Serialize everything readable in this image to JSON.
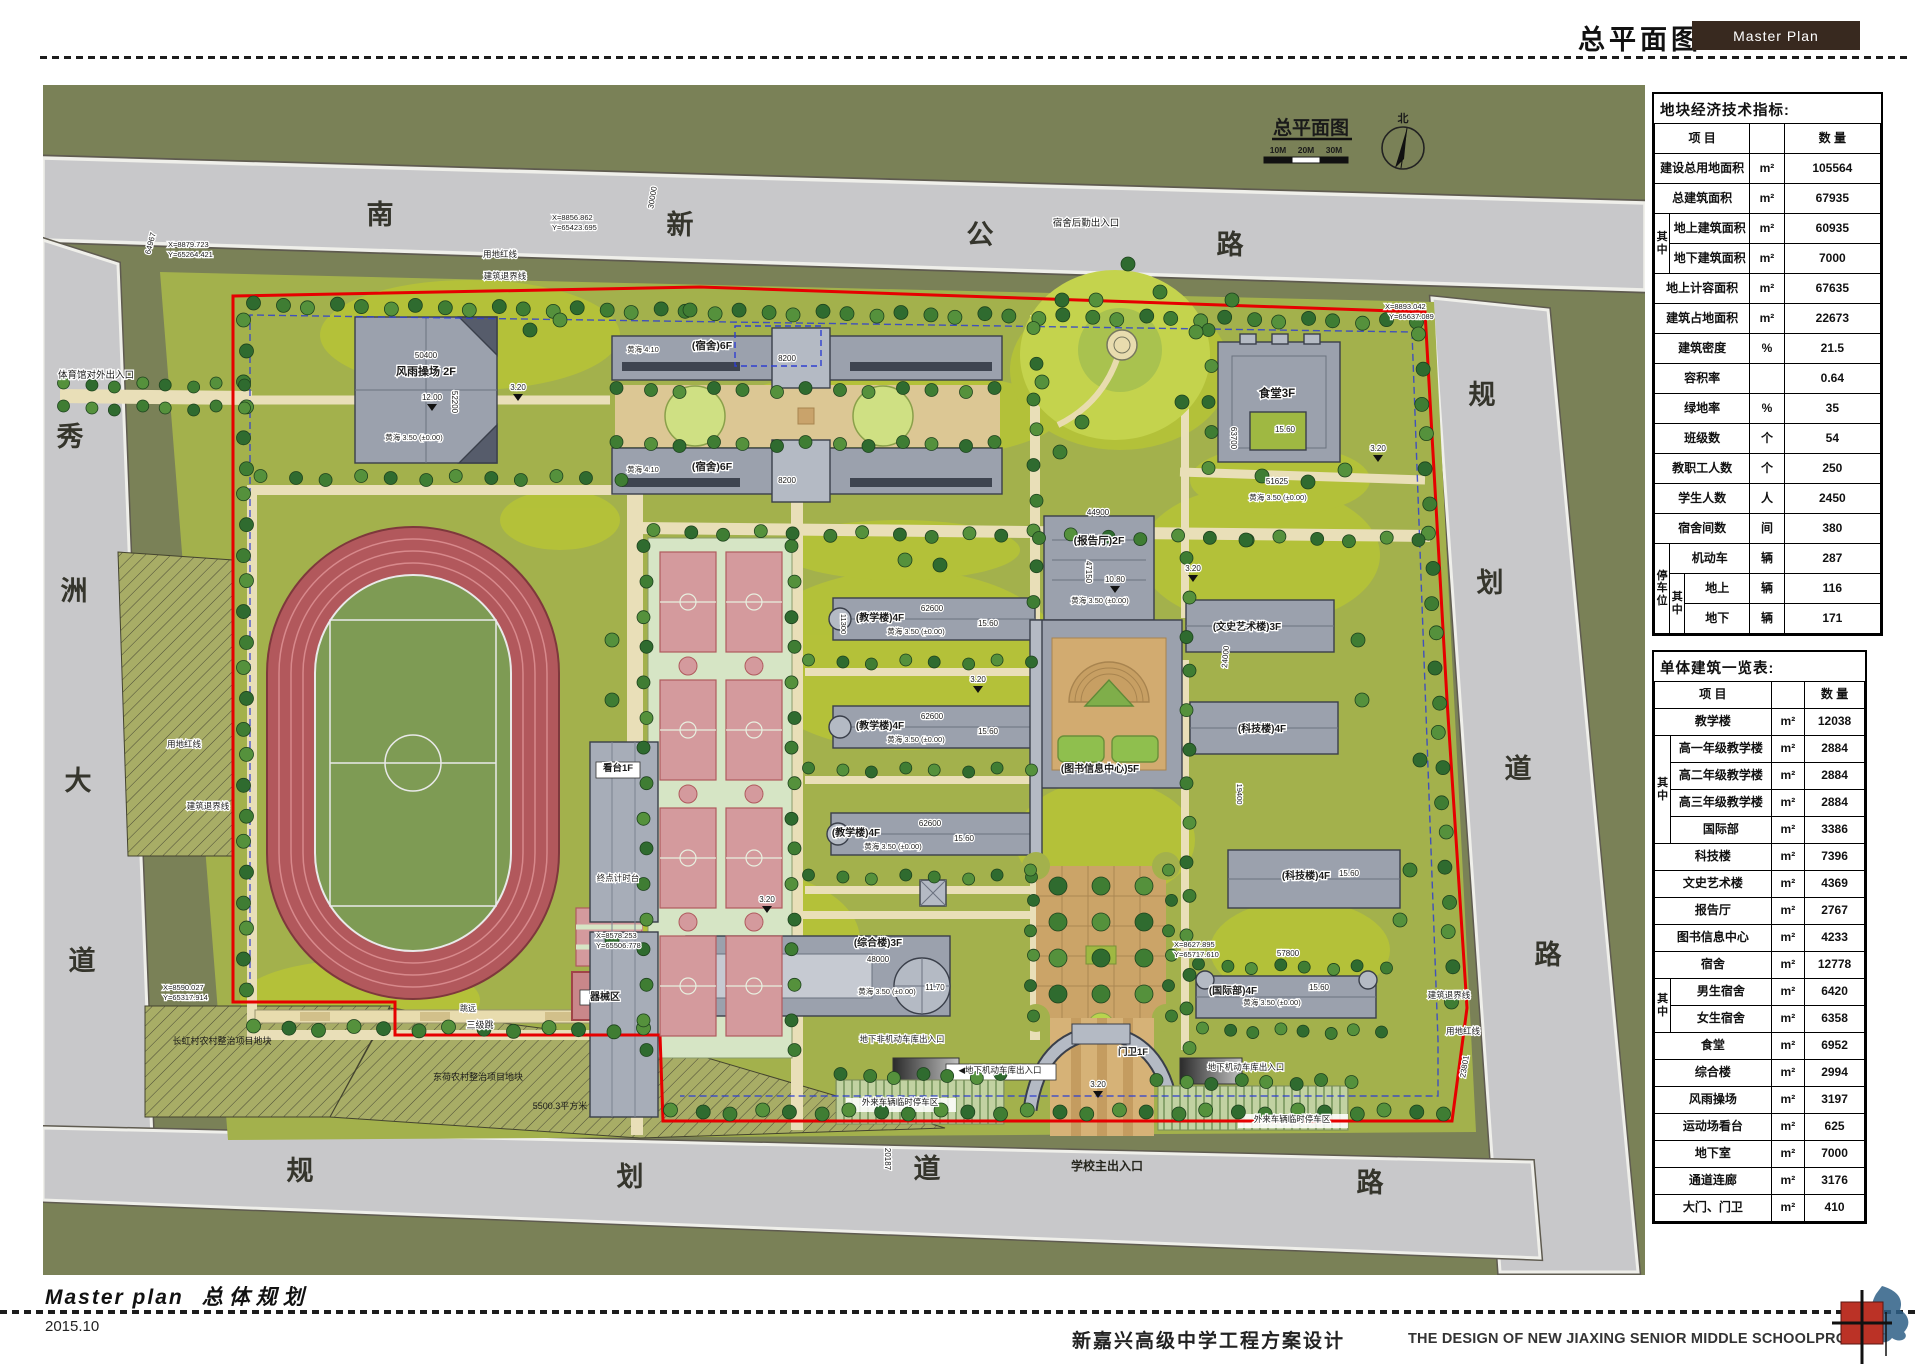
{
  "header": {
    "sheet_title": "总平面图",
    "badge": "Master Plan"
  },
  "footer": {
    "title_en": "Master plan",
    "title_cn": "总体规划",
    "date": "2015.10",
    "project_cn": "新嘉兴高级中学工程方案设计",
    "project_en": "THE DESIGN OF NEW JIAXING SENIOR MIDDLE SCHOOLPROJECT"
  },
  "colors": {
    "badge_bg": "#38291f",
    "boundary_red": "#e60000",
    "setback_blue": "#2f3fd0",
    "road_gray": "#c8c8ca",
    "site_green": "#a3b14c",
    "context_green": "#7a8157"
  },
  "tables": [
    {
      "title": "地块经济技术指标:",
      "item_header": "项    目",
      "qty_header": "数  量",
      "depth": 3,
      "cols": [
        15,
        15,
        64,
        34,
        95
      ],
      "rows": [
        {
          "label": "建设总用地面积",
          "unit": "m²",
          "value": "105564"
        },
        {
          "label": "总建筑面积",
          "unit": "m²",
          "value": "67935"
        },
        {
          "g1": "其中",
          "g1s": 2,
          "label": "地上建筑面积",
          "unit": "m²",
          "value": "60935"
        },
        {
          "label": "地下建筑面积",
          "unit": "m²",
          "value": "7000"
        },
        {
          "label": "地上计容面积",
          "unit": "m²",
          "value": "67635"
        },
        {
          "label": "建筑占地面积",
          "unit": "m²",
          "value": "22673"
        },
        {
          "label": "建筑密度",
          "unit": "%",
          "value": "21.5"
        },
        {
          "label": "容积率",
          "unit": "",
          "value": "0.64"
        },
        {
          "label": "绿地率",
          "unit": "%",
          "value": "35"
        },
        {
          "label": "班级数",
          "unit": "个",
          "value": "54"
        },
        {
          "label": "教职工人数",
          "unit": "个",
          "value": "250"
        },
        {
          "label": "学生人数",
          "unit": "人",
          "value": "2450"
        },
        {
          "label": "宿舍间数",
          "unit": "间",
          "value": "380"
        },
        {
          "g1": "停车位",
          "g1s": 3,
          "label": "机动车",
          "unit": "辆",
          "value": "287"
        },
        {
          "g2": "其中",
          "g2s": 2,
          "label": "地上",
          "unit": "辆",
          "value": "116"
        },
        {
          "label": "地下",
          "unit": "辆",
          "value": "171"
        }
      ]
    },
    {
      "title": "单体建筑一览表:",
      "item_header": "项    目",
      "qty_header": "数  量",
      "depth": 2,
      "cols": [
        16,
        99,
        33,
        59
      ],
      "rows": [
        {
          "label": "教学楼",
          "unit": "m²",
          "value": "12038"
        },
        {
          "g1": "其中",
          "g1s": 4,
          "label": "高一年级教学楼",
          "unit": "m²",
          "value": "2884"
        },
        {
          "label": "高二年级教学楼",
          "unit": "m²",
          "value": "2884"
        },
        {
          "label": "高三年级教学楼",
          "unit": "m²",
          "value": "2884"
        },
        {
          "label": "国际部",
          "unit": "m²",
          "value": "3386"
        },
        {
          "label": "科技楼",
          "unit": "m²",
          "value": "7396"
        },
        {
          "label": "文史艺术楼",
          "unit": "m²",
          "value": "4369"
        },
        {
          "label": "报告厅",
          "unit": "m²",
          "value": "2767"
        },
        {
          "label": "图书信息中心",
          "unit": "m²",
          "value": "4233"
        },
        {
          "label": "宿舍",
          "unit": "m²",
          "value": "12778"
        },
        {
          "g1": "其中",
          "g1s": 2,
          "label": "男生宿舍",
          "unit": "m²",
          "value": "6420"
        },
        {
          "label": "女生宿舍",
          "unit": "m²",
          "value": "6358"
        },
        {
          "label": "食堂",
          "unit": "m²",
          "value": "6952"
        },
        {
          "label": "综合楼",
          "unit": "m²",
          "value": "2994"
        },
        {
          "label": "风雨操场",
          "unit": "m²",
          "value": "3197"
        },
        {
          "label": "运动场看台",
          "unit": "m²",
          "value": "625"
        },
        {
          "label": "地下室",
          "unit": "m²",
          "value": "7000"
        },
        {
          "label": "通道连廊",
          "unit": "m²",
          "value": "3176"
        },
        {
          "label": "大门、门卫",
          "unit": "m²",
          "value": "410"
        }
      ]
    }
  ],
  "map": {
    "title": "总平面图",
    "scale_labels": [
      "10M",
      "20M",
      "30M"
    ],
    "north_label": "北",
    "labels": [
      {
        "t": "南",
        "x": 380,
        "y": 224,
        "s": 27,
        "w": 1,
        "c": "#35352c"
      },
      {
        "t": "新",
        "x": 680,
        "y": 234,
        "s": 27,
        "w": 1,
        "c": "#35352c"
      },
      {
        "t": "公",
        "x": 980,
        "y": 244,
        "s": 27,
        "w": 1,
        "c": "#35352c"
      },
      {
        "t": "路",
        "x": 1230,
        "y": 254,
        "s": 27,
        "w": 1,
        "c": "#35352c"
      },
      {
        "t": "秀",
        "x": 70,
        "y": 446,
        "s": 27,
        "w": 1,
        "c": "#35352c"
      },
      {
        "t": "洲",
        "x": 74,
        "y": 600,
        "s": 27,
        "w": 1,
        "c": "#35352c"
      },
      {
        "t": "大",
        "x": 78,
        "y": 790,
        "s": 27,
        "w": 1,
        "c": "#35352c"
      },
      {
        "t": "道",
        "x": 82,
        "y": 970,
        "s": 27,
        "w": 1,
        "c": "#35352c"
      },
      {
        "t": "规",
        "x": 1482,
        "y": 404,
        "s": 27,
        "w": 1,
        "c": "#35352c"
      },
      {
        "t": "划",
        "x": 1490,
        "y": 592,
        "s": 27,
        "w": 1,
        "c": "#35352c"
      },
      {
        "t": "道",
        "x": 1518,
        "y": 778,
        "s": 27,
        "w": 1,
        "c": "#35352c"
      },
      {
        "t": "路",
        "x": 1548,
        "y": 964,
        "s": 27,
        "w": 1,
        "c": "#35352c"
      },
      {
        "t": "规",
        "x": 300,
        "y": 1180,
        "s": 27,
        "w": 1,
        "c": "#35352c"
      },
      {
        "t": "划",
        "x": 630,
        "y": 1186,
        "s": 27,
        "w": 1,
        "c": "#35352c"
      },
      {
        "t": "道",
        "x": 927,
        "y": 1178,
        "s": 27,
        "w": 1,
        "c": "#35352c"
      },
      {
        "t": "路",
        "x": 1370,
        "y": 1192,
        "s": 27,
        "w": 1,
        "c": "#35352c"
      },
      {
        "t": "总平面图",
        "x": 1311,
        "y": 134,
        "s": 19,
        "w": 1
      },
      {
        "t": "10M",
        "x": 1278,
        "y": 153,
        "s": 8.5,
        "w": 1
      },
      {
        "t": "20M",
        "x": 1306,
        "y": 153,
        "s": 8.5,
        "w": 1
      },
      {
        "t": "30M",
        "x": 1334,
        "y": 153,
        "s": 8.5,
        "w": 1
      },
      {
        "t": "北",
        "x": 1403,
        "y": 122,
        "s": 11,
        "w": 1
      },
      {
        "t": "风雨操场 2F",
        "x": 426,
        "y": 375,
        "s": 11,
        "w": 1,
        "h": 1
      },
      {
        "t": "(宿舍)6F",
        "x": 712,
        "y": 349,
        "s": 10.5,
        "w": 1,
        "h": 1
      },
      {
        "t": "(宿舍)6F",
        "x": 712,
        "y": 470,
        "s": 10.5,
        "w": 1,
        "h": 1
      },
      {
        "t": "食堂3F",
        "x": 1277,
        "y": 397,
        "s": 11.5,
        "w": 1,
        "h": 1
      },
      {
        "t": "(报告厅)2F",
        "x": 1099,
        "y": 544,
        "s": 10.5,
        "w": 1,
        "h": 1
      },
      {
        "t": "(教学楼)4F",
        "x": 880,
        "y": 621,
        "s": 10,
        "w": 1,
        "h": 1
      },
      {
        "t": "(教学楼)4F",
        "x": 880,
        "y": 729,
        "s": 10,
        "w": 1,
        "h": 1
      },
      {
        "t": "(教学楼)4F",
        "x": 856,
        "y": 836,
        "s": 10,
        "w": 1,
        "h": 1
      },
      {
        "t": "(图书信息中心)5F",
        "x": 1100,
        "y": 772,
        "s": 10,
        "w": 1,
        "h": 1
      },
      {
        "t": "(文史艺术楼)3F",
        "x": 1247,
        "y": 630,
        "s": 10,
        "w": 1,
        "h": 1
      },
      {
        "t": "(科技楼)4F",
        "x": 1262,
        "y": 732,
        "s": 10,
        "w": 1,
        "h": 1
      },
      {
        "t": "(科技楼)4F",
        "x": 1306,
        "y": 879,
        "s": 10,
        "w": 1,
        "h": 1
      },
      {
        "t": "(综合楼)3F",
        "x": 878,
        "y": 946,
        "s": 10,
        "w": 1,
        "h": 1
      },
      {
        "t": "(国际部)4F",
        "x": 1233,
        "y": 994,
        "s": 10,
        "w": 1,
        "h": 1
      },
      {
        "t": "看台1F",
        "x": 618,
        "y": 771,
        "s": 9.5,
        "w": 1,
        "h": 1
      },
      {
        "t": "器械区",
        "x": 605,
        "y": 1000,
        "s": 10,
        "w": 1,
        "h": 1
      },
      {
        "t": "门卫1F",
        "x": 1133,
        "y": 1055,
        "s": 9.5,
        "w": 1,
        "h": 1
      },
      {
        "t": "宿舍后勤出入口",
        "x": 1086,
        "y": 226,
        "s": 9.5,
        "h": 1
      },
      {
        "t": "体育馆对外出入口",
        "x": 58,
        "y": 378,
        "s": 9.5,
        "a": "start",
        "h": 1
      },
      {
        "t": "学校主出入口",
        "x": 1107,
        "y": 1170,
        "s": 12,
        "w": 1,
        "c": "#26261e"
      },
      {
        "t": "地下非机动车库出入口",
        "x": 902,
        "y": 1042,
        "s": 8.5,
        "h": 1
      },
      {
        "t": "◀地下机动车库出入口",
        "x": 1000,
        "y": 1073,
        "s": 8.5,
        "h": 1
      },
      {
        "t": "地下机动车库出入口",
        "x": 1246,
        "y": 1070,
        "s": 8.5,
        "h": 1
      },
      {
        "t": "外来车辆临时停车区",
        "x": 900,
        "y": 1105,
        "s": 8.5,
        "h": 1
      },
      {
        "t": "外来车辆临时停车区",
        "x": 1292,
        "y": 1122,
        "s": 8.5,
        "h": 1
      },
      {
        "t": "终点计时台",
        "x": 618,
        "y": 881,
        "s": 8.5,
        "h": 1
      },
      {
        "t": "三级跳",
        "x": 480,
        "y": 1028,
        "s": 9,
        "h": 1
      },
      {
        "t": "跳远",
        "x": 468,
        "y": 1011,
        "s": 8,
        "h": 1
      },
      {
        "t": "长虹村农村整治项目地块",
        "x": 222,
        "y": 1044,
        "s": 9
      },
      {
        "t": "东荷农村整治项目地块",
        "x": 478,
        "y": 1080,
        "s": 9
      },
      {
        "t": "5500.3平方米",
        "x": 560,
        "y": 1109,
        "s": 9
      },
      {
        "t": "用地红线",
        "x": 500,
        "y": 257,
        "s": 8.5,
        "h": 1
      },
      {
        "t": "建筑退界线",
        "x": 505,
        "y": 279,
        "s": 8.5,
        "h": 1
      },
      {
        "t": "用地红线",
        "x": 184,
        "y": 747,
        "s": 8.5,
        "h": 1
      },
      {
        "t": "建筑退界线",
        "x": 208,
        "y": 809,
        "s": 8.5,
        "h": 1
      },
      {
        "t": "建筑退界线",
        "x": 1449,
        "y": 998,
        "s": 8.5,
        "h": 1
      },
      {
        "t": "用地红线",
        "x": 1463,
        "y": 1034,
        "s": 8.5,
        "h": 1
      },
      {
        "t": "黄海 3.50 (±0.00)",
        "x": 414,
        "y": 440,
        "s": 7.5,
        "h": 1
      },
      {
        "t": "黄海 3.50 (±0.00)",
        "x": 1100,
        "y": 603,
        "s": 7.5,
        "h": 1
      },
      {
        "t": "黄海 3.50 (±0.00)",
        "x": 1278,
        "y": 500,
        "s": 7.5,
        "h": 1
      },
      {
        "t": "黄海 3.50 (±0.00)",
        "x": 916,
        "y": 634,
        "s": 7.5,
        "h": 1
      },
      {
        "t": "黄海 3.50 (±0.00)",
        "x": 916,
        "y": 742,
        "s": 7.5,
        "h": 1
      },
      {
        "t": "黄海 3.50 (±0.00)",
        "x": 893,
        "y": 849,
        "s": 7.5,
        "h": 1
      },
      {
        "t": "黄海 3.50 (±0.00)",
        "x": 887,
        "y": 994,
        "s": 7.5,
        "h": 1
      },
      {
        "t": "黄海 3.50 (±0.00)",
        "x": 1272,
        "y": 1005,
        "s": 7.5,
        "h": 1
      },
      {
        "t": "黄海 4.10",
        "x": 643,
        "y": 352,
        "s": 7.5,
        "h": 1
      },
      {
        "t": "黄海 4.10",
        "x": 643,
        "y": 472,
        "s": 7.5,
        "h": 1
      },
      {
        "t": "12.00",
        "x": 432,
        "y": 400,
        "s": 8,
        "h": 1
      },
      {
        "t": "10.80",
        "x": 1115,
        "y": 582,
        "s": 8,
        "h": 1
      },
      {
        "t": "11.70",
        "x": 935,
        "y": 990,
        "s": 8,
        "h": 1
      },
      {
        "t": "15.60",
        "x": 988,
        "y": 626,
        "s": 8,
        "h": 1
      },
      {
        "t": "15.60",
        "x": 988,
        "y": 734,
        "s": 8,
        "h": 1
      },
      {
        "t": "15.60",
        "x": 964,
        "y": 841,
        "s": 8,
        "h": 1
      },
      {
        "t": "15.60",
        "x": 1285,
        "y": 432,
        "s": 8,
        "h": 1
      },
      {
        "t": "15.60",
        "x": 1319,
        "y": 990,
        "s": 8,
        "h": 1
      },
      {
        "t": "15.60",
        "x": 1349,
        "y": 876,
        "s": 8,
        "h": 1
      },
      {
        "t": "3.20",
        "x": 518,
        "y": 390,
        "s": 8,
        "h": 1
      },
      {
        "t": "3.20",
        "x": 978,
        "y": 682,
        "s": 8,
        "h": 1
      },
      {
        "t": "3.20",
        "x": 1378,
        "y": 451,
        "s": 8,
        "h": 1
      },
      {
        "t": "3.20",
        "x": 1193,
        "y": 571,
        "s": 8,
        "h": 1
      },
      {
        "t": "3.20",
        "x": 767,
        "y": 902,
        "s": 8,
        "h": 1
      },
      {
        "t": "3.20",
        "x": 1098,
        "y": 1087,
        "s": 8,
        "h": 1
      },
      {
        "t": "50400",
        "x": 426,
        "y": 358,
        "s": 8,
        "h": 1
      },
      {
        "t": "52200",
        "x": 452,
        "y": 402,
        "s": 8,
        "r": 90,
        "h": 1
      },
      {
        "t": "44900",
        "x": 1098,
        "y": 515,
        "s": 8,
        "h": 1
      },
      {
        "t": "47150",
        "x": 1086,
        "y": 572,
        "s": 8,
        "r": 90,
        "h": 1
      },
      {
        "t": "62600",
        "x": 932,
        "y": 611,
        "s": 8,
        "h": 1
      },
      {
        "t": "62600",
        "x": 932,
        "y": 719,
        "s": 8,
        "h": 1
      },
      {
        "t": "62600",
        "x": 930,
        "y": 826,
        "s": 8,
        "h": 1
      },
      {
        "t": "48000",
        "x": 878,
        "y": 962,
        "s": 8,
        "h": 1
      },
      {
        "t": "57800",
        "x": 1288,
        "y": 956,
        "s": 8,
        "h": 1
      },
      {
        "t": "51625",
        "x": 1277,
        "y": 484,
        "s": 8,
        "h": 1
      },
      {
        "t": "63700",
        "x": 1231,
        "y": 438,
        "s": 8,
        "r": 90,
        "h": 1
      },
      {
        "t": "8200",
        "x": 787,
        "y": 361,
        "s": 8,
        "h": 1
      },
      {
        "t": "8200",
        "x": 787,
        "y": 483,
        "s": 8,
        "h": 1
      },
      {
        "t": "11300",
        "x": 841,
        "y": 624,
        "s": 7.5,
        "r": 90,
        "h": 1
      },
      {
        "t": "19400",
        "x": 1237,
        "y": 794,
        "s": 7.5,
        "r": 90,
        "h": 1
      },
      {
        "t": "64967",
        "x": 153,
        "y": 244,
        "s": 8,
        "r": -75,
        "h": 1
      },
      {
        "t": "30000",
        "x": 655,
        "y": 198,
        "s": 8,
        "r": -80,
        "h": 1
      },
      {
        "t": "24000",
        "x": 1228,
        "y": 657,
        "s": 8,
        "r": -85,
        "h": 1
      },
      {
        "t": "20187",
        "x": 885,
        "y": 1159,
        "s": 8,
        "r": 90,
        "h": 1
      },
      {
        "t": "23801",
        "x": 1467,
        "y": 1067,
        "s": 8,
        "r": -80,
        "h": 1
      },
      {
        "t": "X=8879.723",
        "x": 168,
        "y": 247,
        "s": 7.5,
        "a": "start",
        "h": 1
      },
      {
        "t": "Y=65264.421",
        "x": 168,
        "y": 257,
        "s": 7.5,
        "a": "start",
        "h": 1
      },
      {
        "t": "X=8856.862",
        "x": 552,
        "y": 220,
        "s": 7.5,
        "a": "start",
        "h": 1
      },
      {
        "t": "Y=65423.695",
        "x": 552,
        "y": 230,
        "s": 7.5,
        "a": "start",
        "h": 1
      },
      {
        "t": "X=8893.042",
        "x": 1385,
        "y": 309,
        "s": 7.5,
        "a": "start",
        "h": 1
      },
      {
        "t": "Y=65637.089",
        "x": 1389,
        "y": 319,
        "s": 7.5,
        "a": "start",
        "h": 1
      },
      {
        "t": "X=8590.027",
        "x": 163,
        "y": 990,
        "s": 7.5,
        "a": "start",
        "h": 1
      },
      {
        "t": "Y=65317.914",
        "x": 163,
        "y": 1000,
        "s": 7.5,
        "a": "start",
        "h": 1
      },
      {
        "t": "X=8578.253",
        "x": 596,
        "y": 938,
        "s": 7.5,
        "a": "start",
        "h": 1
      },
      {
        "t": "Y=65506.778",
        "x": 596,
        "y": 948,
        "s": 7.5,
        "a": "start",
        "h": 1
      },
      {
        "t": "X=8627.895",
        "x": 1174,
        "y": 947,
        "s": 7.5,
        "a": "start",
        "h": 1
      },
      {
        "t": "Y=65717.610",
        "x": 1174,
        "y": 957,
        "s": 7.5,
        "a": "start",
        "h": 1
      }
    ]
  }
}
